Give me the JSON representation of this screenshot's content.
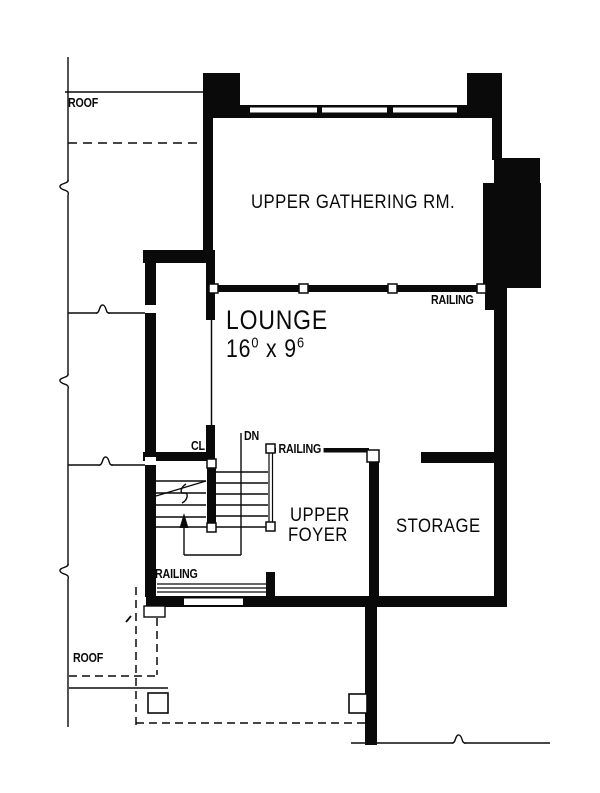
{
  "labels": {
    "roof_top": "ROOF",
    "roof_bottom": "ROOF",
    "upper_gathering_room": "UPPER GATHERING RM.",
    "railing_upper": "RAILING",
    "lounge": "LOUNGE",
    "lounge_dim_feet_1": "16",
    "lounge_dim_inches_1": "0",
    "lounge_dim_separator": " x ",
    "lounge_dim_feet_2": "9",
    "lounge_dim_inches_2": "6",
    "closet": "CL",
    "stairs_down": "DN",
    "railing_stairs": "RAILING",
    "upper_foyer_line1": "UPPER",
    "upper_foyer_line2": "FOYER",
    "storage": "STORAGE",
    "railing_lower": "RAILING"
  },
  "colors": {
    "ink": "#0a0a0a",
    "paper": "#ffffff"
  }
}
